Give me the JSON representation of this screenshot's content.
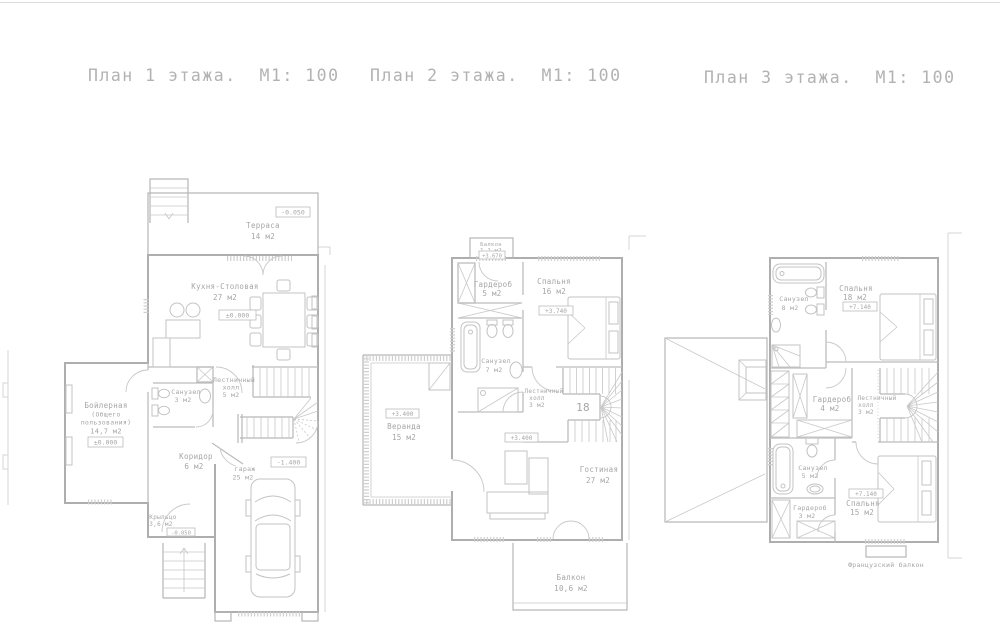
{
  "page": {
    "background": "#ffffff",
    "line_color": "#b4b4b4",
    "text_color": "#a6a6a6"
  },
  "titles": {
    "floor1": "План 1 этажа.  М1: 100",
    "floor2": "План 2 этажа.  М1: 100",
    "floor3": "План 3 этажа.  М1: 100"
  },
  "floor1": {
    "terrace": {
      "name": "Терраса",
      "area": "14 м2",
      "elev": "-0.050"
    },
    "kitchen": {
      "name": "Кухня-Столовая",
      "area": "27 м2",
      "elev": "±0.000"
    },
    "bathroom": {
      "name": "Санузел",
      "area": "3 м2"
    },
    "stair_hall": {
      "name": "Лестничный",
      "name2": "холл",
      "area": "5 м2"
    },
    "boiler": {
      "name": "Бойлерная",
      "name2": "(Общего",
      "name3": "пользования)",
      "area": "14,7 м2",
      "elev": "±0.000"
    },
    "corridor": {
      "name": "Коридор",
      "area": "6 м2"
    },
    "garage": {
      "name": "гараж",
      "area": "25 м2",
      "elev": "-1.400"
    },
    "porch": {
      "name": "Крыльцо",
      "area": "3,6 м2",
      "elev": "-0.050"
    }
  },
  "floor2": {
    "balcony_top": {
      "name": "Балкон",
      "area": "1,1 м2",
      "elev": "+3.670"
    },
    "wardrobe": {
      "name": "Гардероб",
      "area": "5 м2"
    },
    "bedroom": {
      "name": "Спальня",
      "area": "16 м2",
      "elev": "+3.740"
    },
    "bathroom": {
      "name": "Санузел",
      "area": "7 м2"
    },
    "stair_hall": {
      "name": "Лестничный",
      "name2": "холл",
      "area": "3 м2",
      "steps": "18"
    },
    "veranda": {
      "name": "Веранда",
      "area": "15 м2",
      "elev": "+3.400"
    },
    "living": {
      "name": "Гостиная",
      "area": "27 м2",
      "elev": "+3.400"
    },
    "balcony_bottom": {
      "name": "Балкон",
      "area": "10,6 м2"
    }
  },
  "floor3": {
    "bathroom_top": {
      "name": "Санузел",
      "area": "8 м2"
    },
    "bedroom_top": {
      "name": "Спальня",
      "area": "18 м2",
      "elev": "+7.140"
    },
    "wardrobe_mid": {
      "name": "Гардероб",
      "area": "4 м2"
    },
    "stair_hall": {
      "name": "Лестничный",
      "name2": "холл",
      "area": "3 м2"
    },
    "bathroom_bottom": {
      "name": "Санузел",
      "area": "5 м2"
    },
    "wardrobe_bottom": {
      "name": "Гардероб",
      "area": "3 м2"
    },
    "bedroom_bottom": {
      "name": "Спальня",
      "area": "15 м2",
      "elev": "+7.140"
    },
    "french_balcony": {
      "name": "Французский балкон"
    }
  }
}
